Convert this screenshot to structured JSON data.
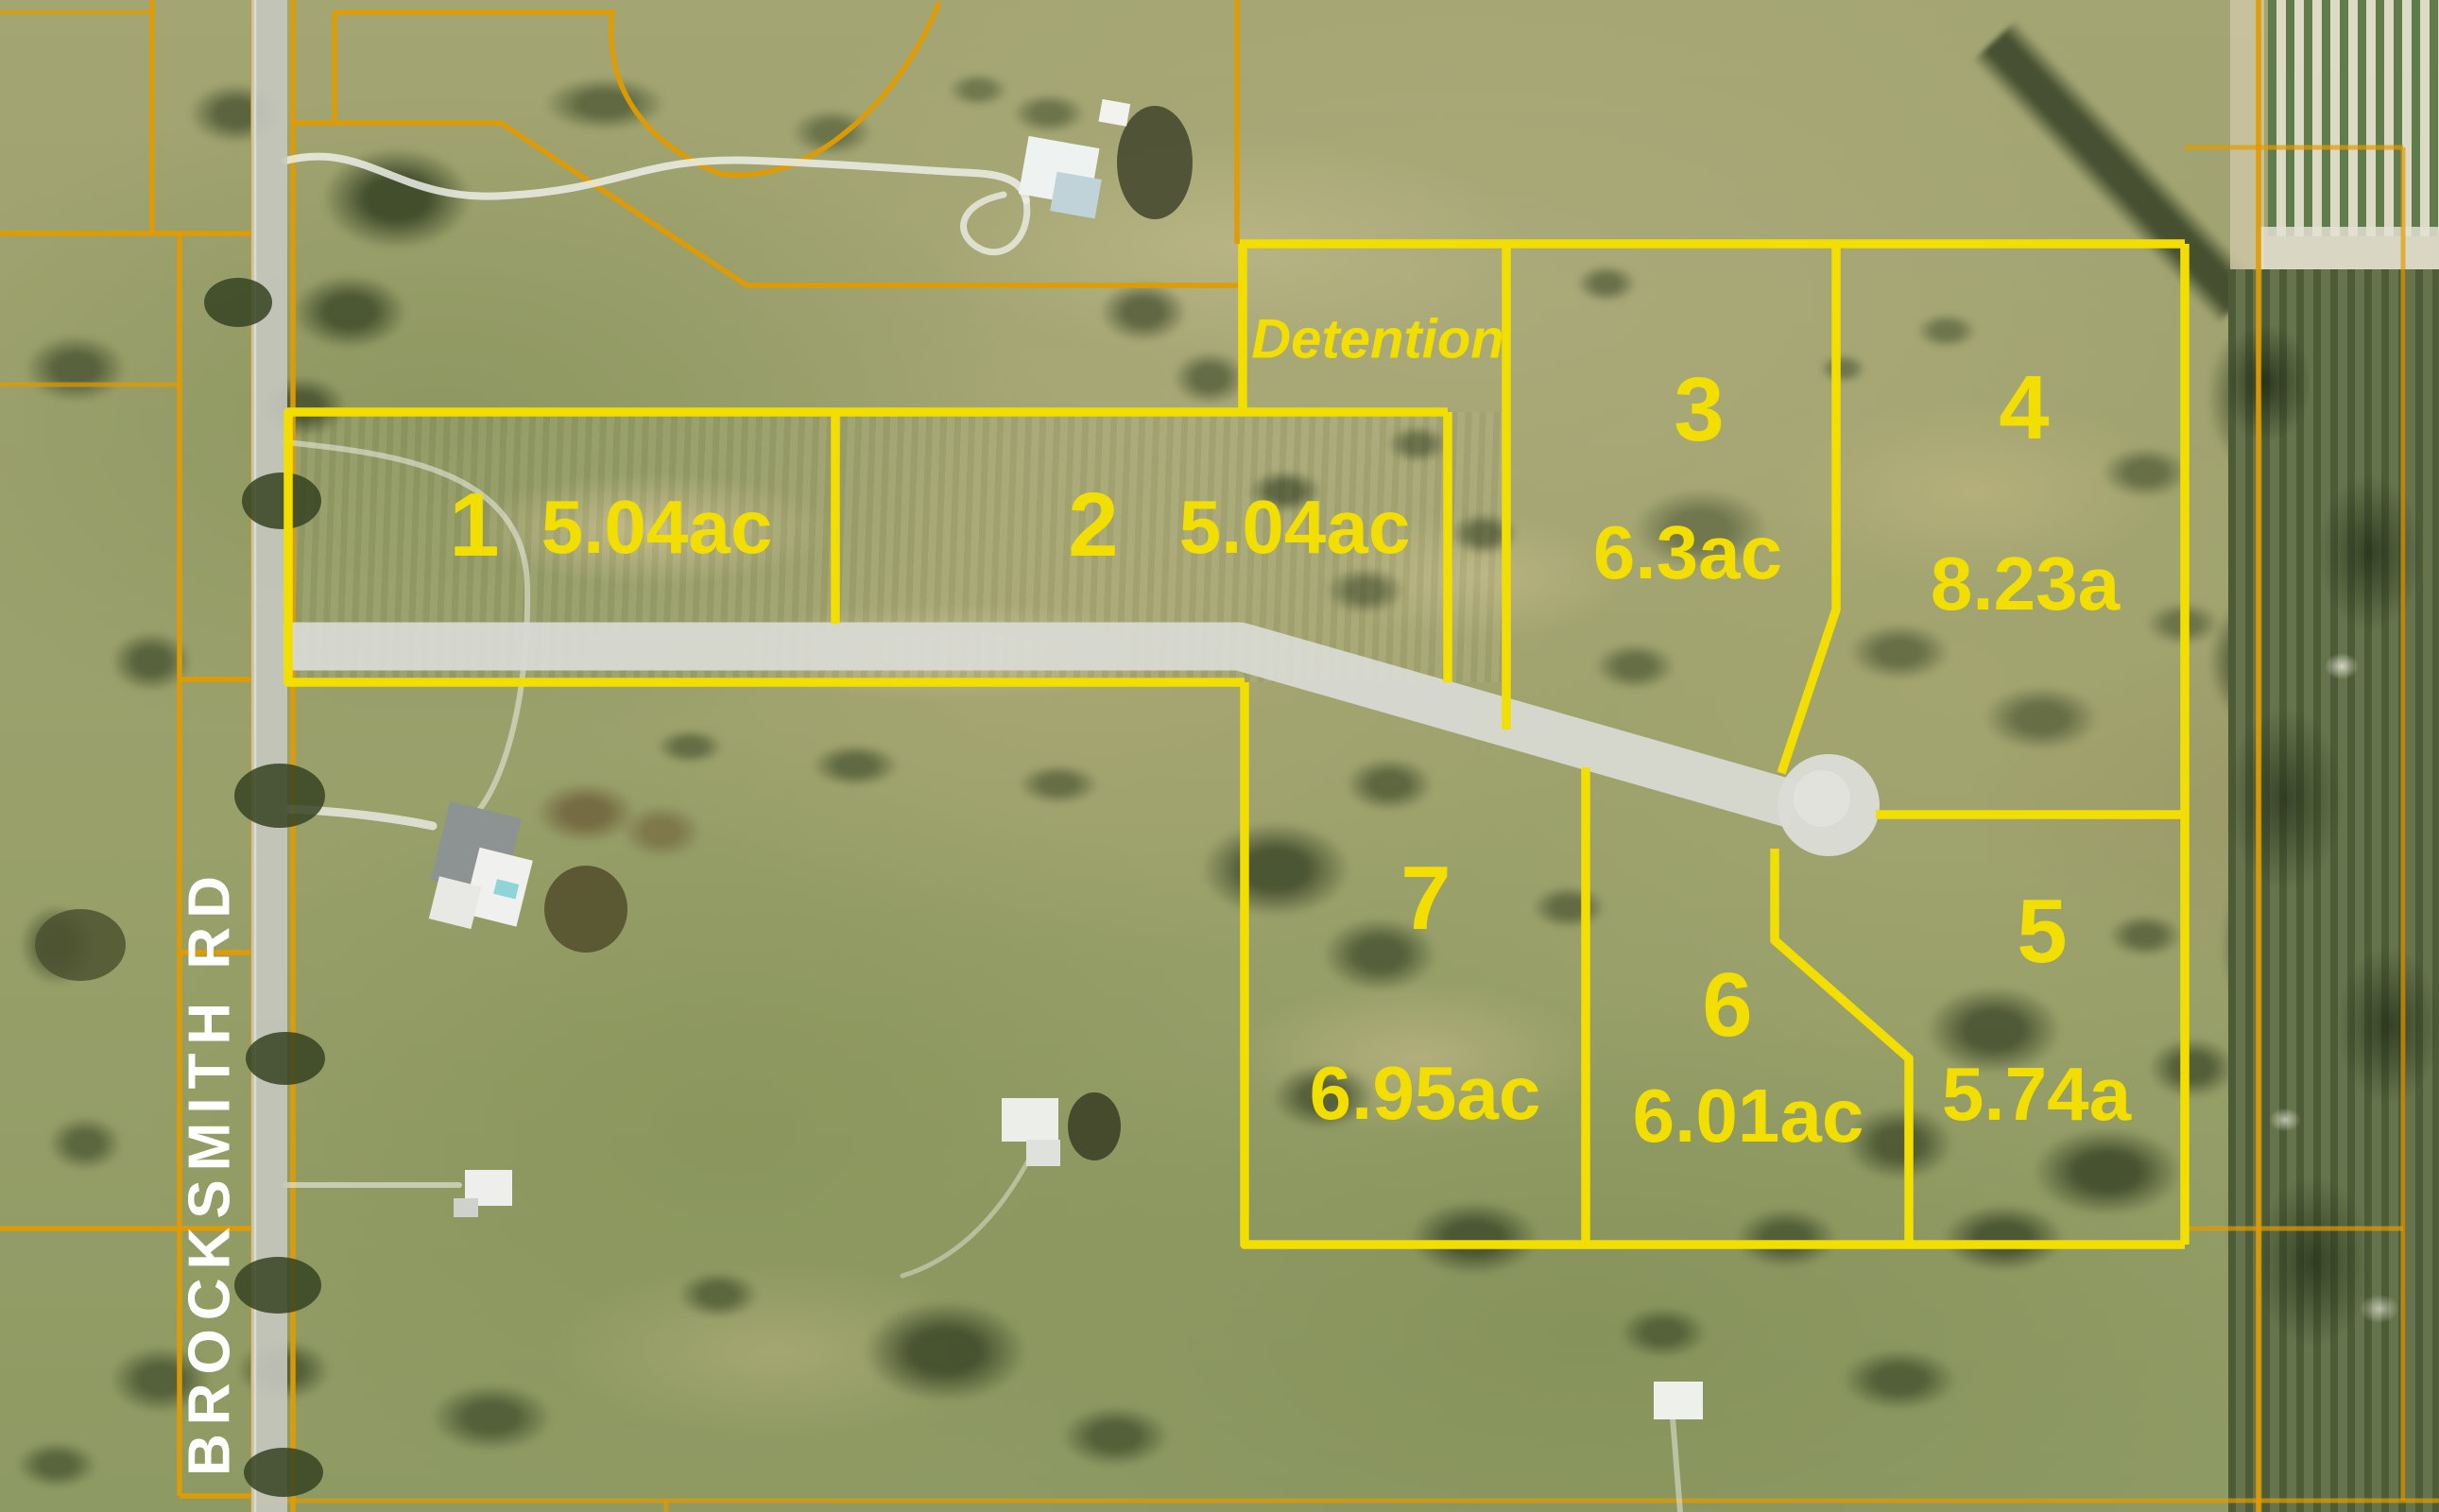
{
  "labels": {
    "brocksmith_rd": "BROCKSMITH RD",
    "detention": "Detention"
  },
  "lots": [
    {
      "number": "1",
      "area": "5.04ac"
    },
    {
      "number": "2",
      "area": "5.04ac"
    },
    {
      "number": "3",
      "area": "6.3ac"
    },
    {
      "number": "4",
      "area": "8.23a"
    },
    {
      "number": "5",
      "area": "5.74a"
    },
    {
      "number": "6",
      "area": "6.01ac"
    },
    {
      "number": "7",
      "area": "6.95ac"
    }
  ],
  "colors": {
    "lot-line": "#F2DE00",
    "parcel-line": "#E29B00",
    "road-fill": "#D8D9D2",
    "culdesac-fill": "#DBDCD6",
    "lot-label": "#F2DE00",
    "road-label": "#FFFFFF"
  }
}
